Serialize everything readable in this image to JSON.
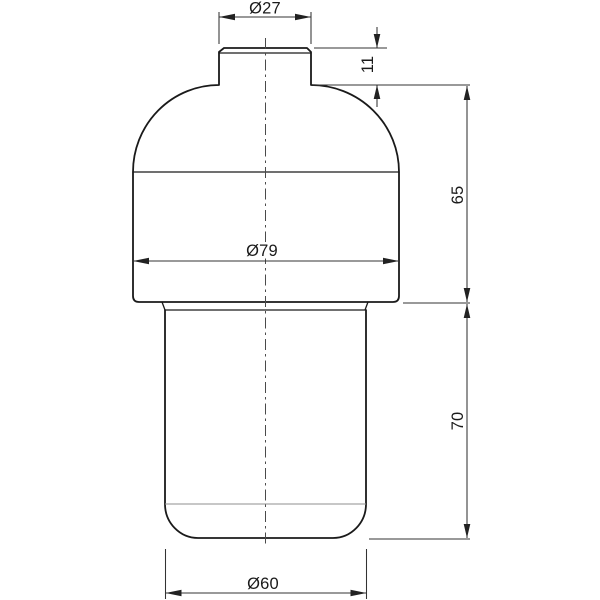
{
  "drawing": {
    "kind": "technical dimension drawing",
    "part": "domed housing with threaded neck and lower bowl"
  },
  "dimensions": {
    "neck_diameter": {
      "label": "Ø27",
      "value": 27
    },
    "neck_height": {
      "label": "11",
      "value": 11
    },
    "head_height": {
      "label": "65",
      "value": 65
    },
    "head_diameter": {
      "label": "Ø79",
      "value": 79
    },
    "bowl_height": {
      "label": "70",
      "value": 70
    },
    "bowl_diameter": {
      "label": "Ø60",
      "value": 60
    }
  },
  "colors": {
    "background": "#ffffff",
    "outline": "#1a1a1a",
    "dimension_lines": "#333333",
    "seam_line": "#8f8f8f"
  }
}
